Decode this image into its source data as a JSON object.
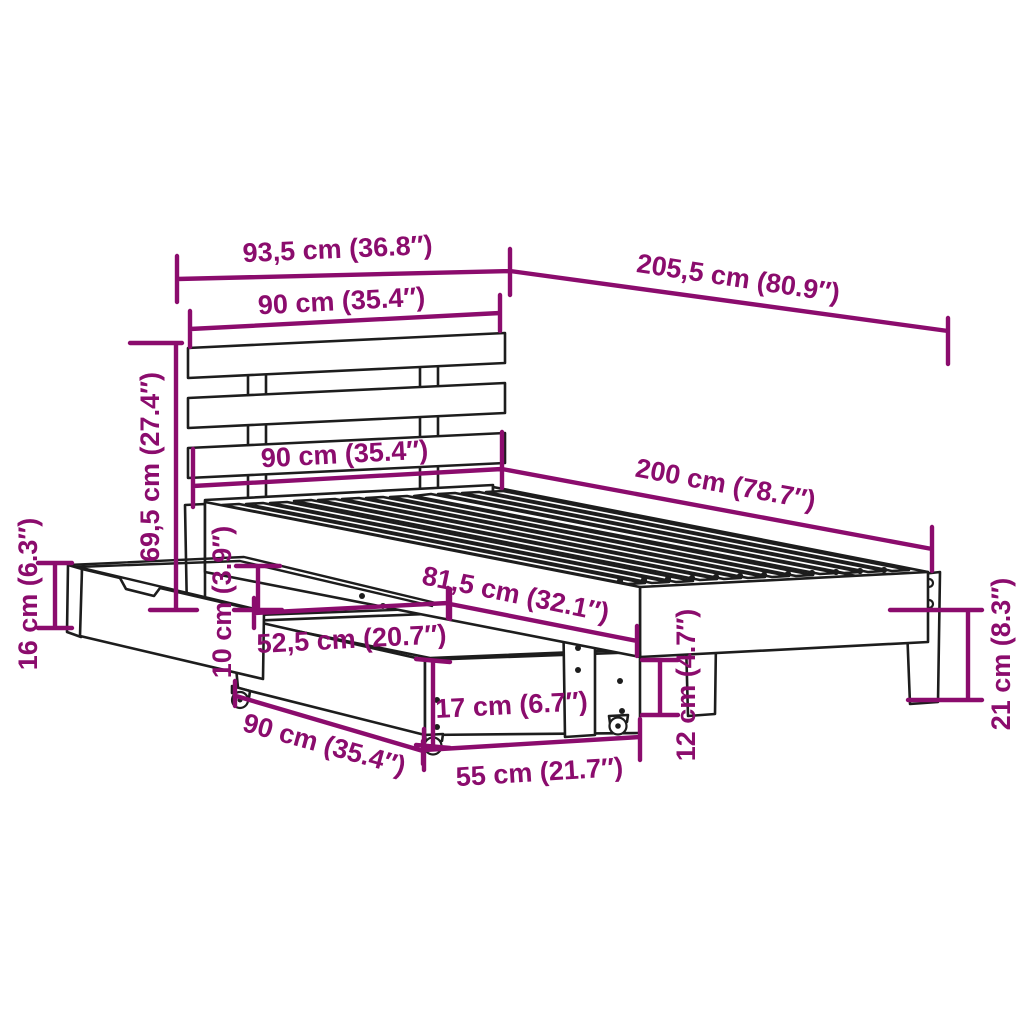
{
  "diagram": {
    "subject": "bed frame with slatted headboard and two under-bed storage drawers",
    "background_color": "#ffffff",
    "drawing_line_color": "#1d1d1d",
    "dimension_color": "#8B0C6D",
    "unit_system": "cm (inches)",
    "dimensions": {
      "overall_width": "93,5 cm (36.8″)",
      "overall_length": "205,5 cm (80.9″)",
      "headboard_width": "90 cm (35.4″)",
      "headboard_height": "69,5 cm (27.4″)",
      "bed_width": "90 cm (35.4″)",
      "bed_length": "200 cm (78.7″)",
      "drawer_end_height": "16 cm (6.3″)",
      "under_bed_clearance": "10 cm (3.9″)",
      "drawer_depth": "52,5 cm (20.7″)",
      "drawer_bay_length": "81,5 cm (32.1″)",
      "drawer_width": "90 cm (35.4″)",
      "drawer_front_height": "17 cm (6.7″)",
      "drawer_length": "55 cm (21.7″)",
      "drawer_wall_height": "12 cm (4.7″)",
      "leg_height": "21 cm (8.3″)"
    }
  }
}
